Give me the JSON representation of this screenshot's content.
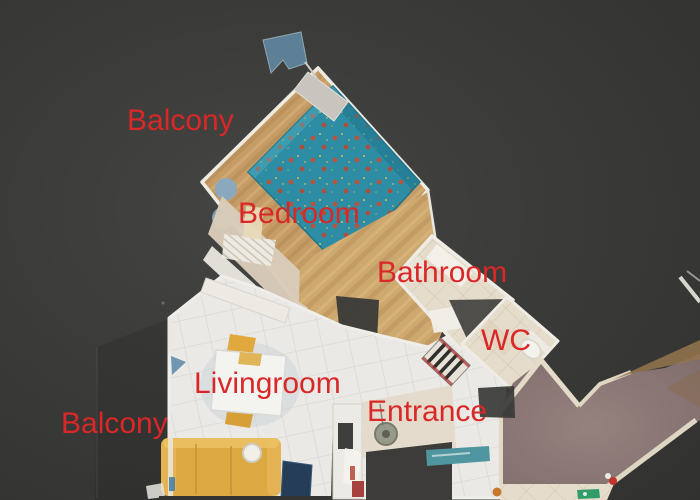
{
  "labels": {
    "balcony_top": "Balcony",
    "bedroom": "Bedroom",
    "bathroom": "Bathroom",
    "wc": "WC",
    "livingroom": "Livingroom",
    "entrance": "Entrance",
    "balcony_bottom": "Balcony"
  },
  "colors": {
    "label": "#da2727",
    "background": "#3a3a38",
    "bed": "#2d8da4",
    "bed_dot": "#b65441",
    "wood": "#c59c66",
    "tile": "#eae9e6",
    "bath_tile": "#e6dccb",
    "corridor": "#8d797b",
    "sofa": "#dca943"
  }
}
